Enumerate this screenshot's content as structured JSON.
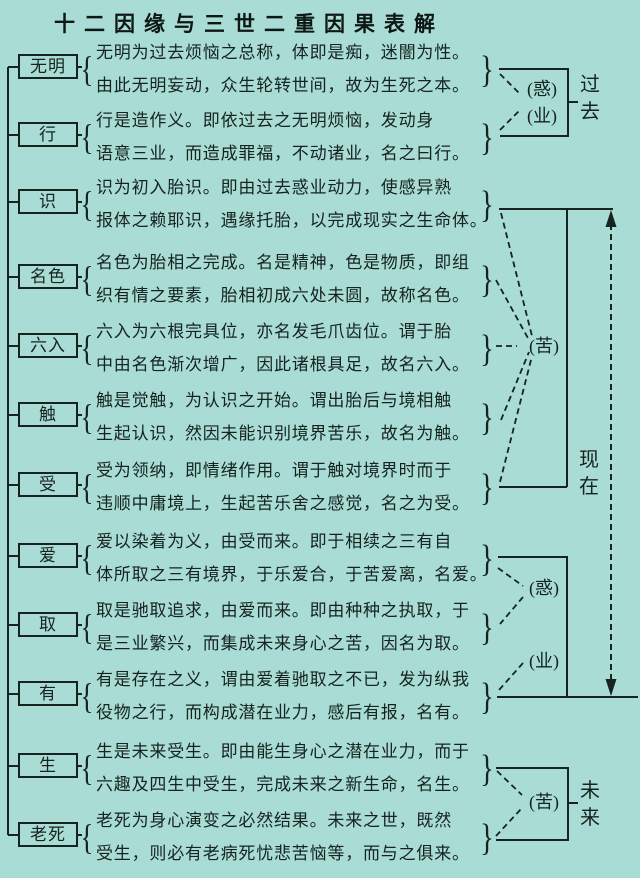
{
  "title": "十二因缘与三世二重因果表解",
  "colors": {
    "background": "#a8dcd4",
    "ink": "#16231f"
  },
  "glyphs": {
    "open_brace": "{",
    "close_brace": "}"
  },
  "rows": [
    {
      "term": "无明",
      "line1": "无明为过去烦恼之总称，体即是痴，迷闇为性。",
      "line2": "由此无明妄动，众生轮转世间，故为生死之本。"
    },
    {
      "term": "行",
      "line1": "行是造作义。即依过去之无明烦恼，发动身",
      "line2": "语意三业，而造成罪福，不动诸业，名之曰行。"
    },
    {
      "term": "识",
      "line1": "识为初入胎识。即由过去惑业动力，使感异熟",
      "line2": "报体之赖耶识，遇缘托胎，以完成现实之生命体。"
    },
    {
      "term": "名色",
      "line1": "名色为胎相之完成。名是精神，色是物质，即组",
      "line2": "织有情之要素，胎相初成六处未圆，故称名色。"
    },
    {
      "term": "六入",
      "line1": "六入为六根完具位，亦名发毛爪齿位。谓于胎",
      "line2": "中由名色渐次增广，因此诸根具足，故名六入。"
    },
    {
      "term": "触",
      "line1": "触是觉触，为认识之开始。谓出胎后与境相触",
      "line2": "生起认识，然因未能识别境界苦乐，故名为触。"
    },
    {
      "term": "受",
      "line1": "受为领纳，即情绪作用。谓于触对境界时而于",
      "line2": "违顺中庸境上，生起苦乐舍之感觉，名之为受。"
    },
    {
      "term": "爱",
      "line1": "爱以染着为义，由受而来。即于相续之三有自",
      "line2": "体所取之三有境界，于乐爱合，于苦爱离，名爱。"
    },
    {
      "term": "取",
      "line1": "取是驰取追求，由爱而来。即由种种之执取，于",
      "line2": "是三业繁兴，而集成未来身心之苦，因名为取。"
    },
    {
      "term": "有",
      "line1": "有是存在之义，谓由爱着驰取之不已，发为纵我",
      "line2": "役物之行，而构成潜在业力，感后有报，名有。"
    },
    {
      "term": "生",
      "line1": "生是未来受生。即由能生身心之潜在业力，而于",
      "line2": "六趣及四生中受生，完成未来之新生命，名生。"
    },
    {
      "term": "老死",
      "line1": "老死为身心演变之必然结果。未来之世，既然",
      "line2": "受生，则必有老病死忧悲苦恼等，而与之俱来。"
    }
  ],
  "annotations": {
    "past": {
      "delusion": "(惑)",
      "karma": "(业)",
      "period": "过去"
    },
    "present": {
      "suffering": "(苦)",
      "delusion": "(惑)",
      "karma": "(业)",
      "period": "现在"
    },
    "future": {
      "suffering": "(苦)",
      "period": "未来"
    }
  }
}
